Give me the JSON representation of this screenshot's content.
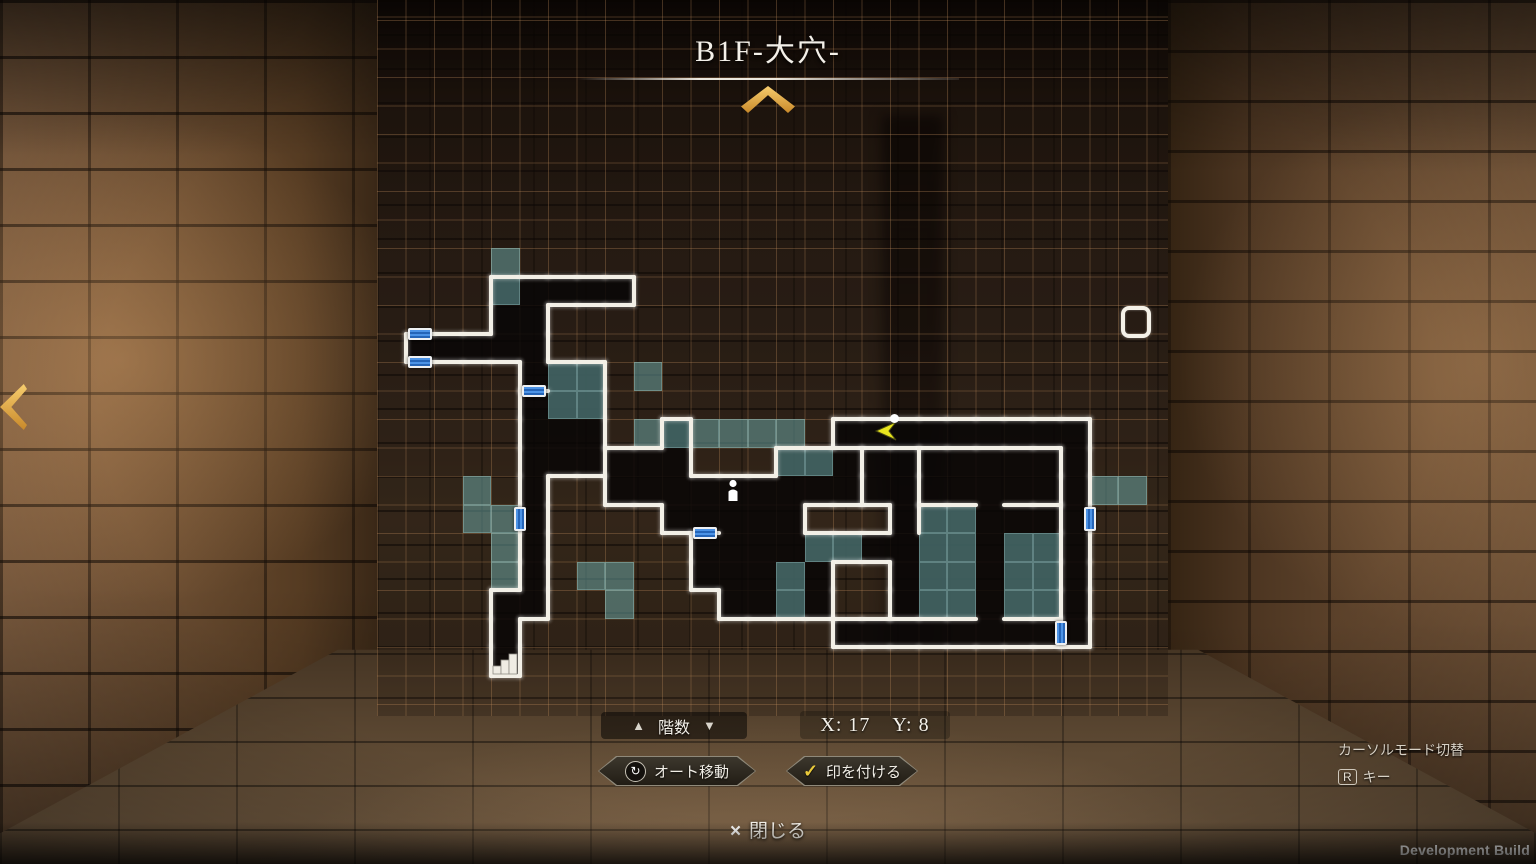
{
  "title": {
    "text": "B1F-大穴-"
  },
  "hud": {
    "floor_selector": {
      "up_icon": "▲",
      "label": "階数",
      "down_icon": "▼"
    },
    "coordinates": {
      "x": "X: 17",
      "y": "Y: 8"
    },
    "buttons": [
      {
        "icon": "auto-move-icon",
        "glyph": "↻",
        "label": "オート移動"
      },
      {
        "icon": "check-icon",
        "glyph": "✓",
        "label": "印を付ける"
      }
    ],
    "close": {
      "icon": "×",
      "label": "閉じる"
    },
    "cursor_help": {
      "title": "カーソルモード切替",
      "key": "R",
      "key_label": "キー"
    },
    "build_label": "Development Build"
  },
  "map": {
    "grid": {
      "left": 377,
      "top": 0,
      "width": 791,
      "height": 716,
      "pitch": 28.5,
      "y_offset": 20
    },
    "colors": {
      "dark": "rgba(8,6,6,0.85)",
      "teal": "rgba(112,176,176,0.5)",
      "teal_edge": "rgba(170,215,215,0.3)",
      "wall": "#f2efe6",
      "door_blue_a": "#4c93e6",
      "door_blue_b": "#2565b8",
      "grid_line": "rgba(188,138,90,0.32)",
      "gold": "#e3a83e"
    },
    "dark_cells": [
      [
        4,
        9
      ],
      [
        5,
        9
      ],
      [
        6,
        9
      ],
      [
        7,
        9
      ],
      [
        8,
        9
      ],
      [
        4,
        10
      ],
      [
        5,
        10
      ],
      [
        1,
        11
      ],
      [
        2,
        11
      ],
      [
        3,
        11
      ],
      [
        4,
        11
      ],
      [
        5,
        11
      ],
      [
        5,
        12
      ],
      [
        6,
        12
      ],
      [
        7,
        12
      ],
      [
        5,
        13
      ],
      [
        6,
        13
      ],
      [
        7,
        13
      ],
      [
        5,
        14
      ],
      [
        6,
        14
      ],
      [
        7,
        14
      ],
      [
        10,
        14
      ],
      [
        16,
        14
      ],
      [
        17,
        14
      ],
      [
        18,
        14
      ],
      [
        19,
        14
      ],
      [
        20,
        14
      ],
      [
        21,
        14
      ],
      [
        22,
        14
      ],
      [
        23,
        14
      ],
      [
        24,
        14
      ],
      [
        5,
        15
      ],
      [
        6,
        15
      ],
      [
        7,
        15
      ],
      [
        8,
        15
      ],
      [
        9,
        15
      ],
      [
        10,
        15
      ],
      [
        14,
        15
      ],
      [
        15,
        15
      ],
      [
        16,
        15
      ],
      [
        17,
        15
      ],
      [
        18,
        15
      ],
      [
        19,
        15
      ],
      [
        20,
        15
      ],
      [
        21,
        15
      ],
      [
        22,
        15
      ],
      [
        23,
        15
      ],
      [
        24,
        15
      ],
      [
        5,
        16
      ],
      [
        8,
        16
      ],
      [
        9,
        16
      ],
      [
        10,
        16
      ],
      [
        11,
        16
      ],
      [
        12,
        16
      ],
      [
        13,
        16
      ],
      [
        14,
        16
      ],
      [
        15,
        16
      ],
      [
        16,
        16
      ],
      [
        17,
        16
      ],
      [
        18,
        16
      ],
      [
        19,
        16
      ],
      [
        20,
        16
      ],
      [
        21,
        16
      ],
      [
        22,
        16
      ],
      [
        23,
        16
      ],
      [
        24,
        16
      ],
      [
        5,
        17
      ],
      [
        10,
        17
      ],
      [
        11,
        17
      ],
      [
        12,
        17
      ],
      [
        13,
        17
      ],
      [
        14,
        17
      ],
      [
        18,
        17
      ],
      [
        19,
        17
      ],
      [
        20,
        17
      ],
      [
        21,
        17
      ],
      [
        22,
        17
      ],
      [
        23,
        17
      ],
      [
        24,
        17
      ],
      [
        5,
        18
      ],
      [
        11,
        18
      ],
      [
        12,
        18
      ],
      [
        13,
        18
      ],
      [
        14,
        18
      ],
      [
        15,
        18
      ],
      [
        16,
        18
      ],
      [
        17,
        18
      ],
      [
        18,
        18
      ],
      [
        19,
        18
      ],
      [
        20,
        18
      ],
      [
        21,
        18
      ],
      [
        22,
        18
      ],
      [
        23,
        18
      ],
      [
        24,
        18
      ],
      [
        5,
        19
      ],
      [
        11,
        19
      ],
      [
        12,
        19
      ],
      [
        13,
        19
      ],
      [
        14,
        19
      ],
      [
        15,
        19
      ],
      [
        18,
        19
      ],
      [
        19,
        19
      ],
      [
        20,
        19
      ],
      [
        21,
        19
      ],
      [
        22,
        19
      ],
      [
        23,
        19
      ],
      [
        24,
        19
      ],
      [
        4,
        20
      ],
      [
        5,
        20
      ],
      [
        12,
        20
      ],
      [
        13,
        20
      ],
      [
        14,
        20
      ],
      [
        15,
        20
      ],
      [
        18,
        20
      ],
      [
        19,
        20
      ],
      [
        20,
        20
      ],
      [
        21,
        20
      ],
      [
        22,
        20
      ],
      [
        23,
        20
      ],
      [
        24,
        20
      ],
      [
        4,
        21
      ],
      [
        16,
        21
      ],
      [
        17,
        21
      ],
      [
        18,
        21
      ],
      [
        19,
        21
      ],
      [
        20,
        21
      ],
      [
        21,
        21
      ],
      [
        22,
        21
      ],
      [
        23,
        21
      ],
      [
        24,
        21
      ],
      [
        4,
        22
      ]
    ],
    "teal_cells": [
      [
        4,
        8
      ],
      [
        4,
        9
      ],
      [
        6,
        12
      ],
      [
        7,
        12
      ],
      [
        9,
        12
      ],
      [
        6,
        13
      ],
      [
        7,
        13
      ],
      [
        9,
        14
      ],
      [
        10,
        14
      ],
      [
        11,
        14
      ],
      [
        12,
        14
      ],
      [
        13,
        14
      ],
      [
        14,
        14
      ],
      [
        14,
        15
      ],
      [
        15,
        15
      ],
      [
        3,
        16
      ],
      [
        25,
        16
      ],
      [
        26,
        16
      ],
      [
        3,
        17
      ],
      [
        4,
        17
      ],
      [
        19,
        17
      ],
      [
        20,
        17
      ],
      [
        4,
        18
      ],
      [
        15,
        18
      ],
      [
        16,
        18
      ],
      [
        19,
        18
      ],
      [
        20,
        18
      ],
      [
        22,
        18
      ],
      [
        23,
        18
      ],
      [
        4,
        19
      ],
      [
        7,
        19
      ],
      [
        8,
        19
      ],
      [
        14,
        19
      ],
      [
        19,
        19
      ],
      [
        20,
        19
      ],
      [
        22,
        19
      ],
      [
        23,
        19
      ],
      [
        8,
        20
      ],
      [
        14,
        20
      ],
      [
        19,
        20
      ],
      [
        20,
        20
      ],
      [
        22,
        20
      ],
      [
        23,
        20
      ]
    ],
    "extra_walls": [
      [
        5,
        12,
        "S"
      ],
      [
        11,
        17,
        "S"
      ],
      [
        24,
        21,
        "W"
      ],
      [
        16,
        14,
        "S"
      ],
      [
        17,
        14,
        "S"
      ],
      [
        18,
        14,
        "S"
      ],
      [
        19,
        14,
        "S"
      ],
      [
        20,
        14,
        "S"
      ],
      [
        21,
        14,
        "S"
      ],
      [
        22,
        14,
        "S"
      ],
      [
        23,
        14,
        "S"
      ],
      [
        24,
        15,
        "W"
      ],
      [
        24,
        16,
        "W"
      ],
      [
        24,
        17,
        "W"
      ],
      [
        24,
        18,
        "W"
      ],
      [
        24,
        19,
        "W"
      ],
      [
        24,
        20,
        "W"
      ],
      [
        17,
        15,
        "W"
      ],
      [
        17,
        16,
        "W"
      ],
      [
        18,
        15,
        "E"
      ],
      [
        18,
        16,
        "E"
      ],
      [
        18,
        17,
        "E"
      ],
      [
        19,
        16,
        "S"
      ],
      [
        20,
        16,
        "S"
      ],
      [
        22,
        16,
        "S"
      ],
      [
        23,
        16,
        "S"
      ],
      [
        18,
        20,
        "S"
      ],
      [
        19,
        20,
        "S"
      ],
      [
        20,
        20,
        "S"
      ],
      [
        22,
        20,
        "S"
      ],
      [
        23,
        20,
        "S"
      ],
      [
        7,
        15,
        "E"
      ]
    ],
    "doors": [
      [
        1,
        11,
        "N"
      ],
      [
        1,
        11,
        "S"
      ],
      [
        5,
        12,
        "S"
      ],
      [
        5,
        17,
        "W"
      ],
      [
        11,
        17,
        "S"
      ],
      [
        24,
        17,
        "E"
      ],
      [
        24,
        21,
        "W"
      ]
    ],
    "markers": {
      "player": {
        "cell": [
          12,
          16
        ]
      },
      "cursor_arrow": {
        "x": 495,
        "y": 421
      },
      "wall_dot": {
        "x": 513,
        "y": 414
      },
      "cursor_box": {
        "cell": [
          26,
          10
        ]
      },
      "stairs": {
        "cell": [
          4,
          22
        ]
      }
    }
  }
}
